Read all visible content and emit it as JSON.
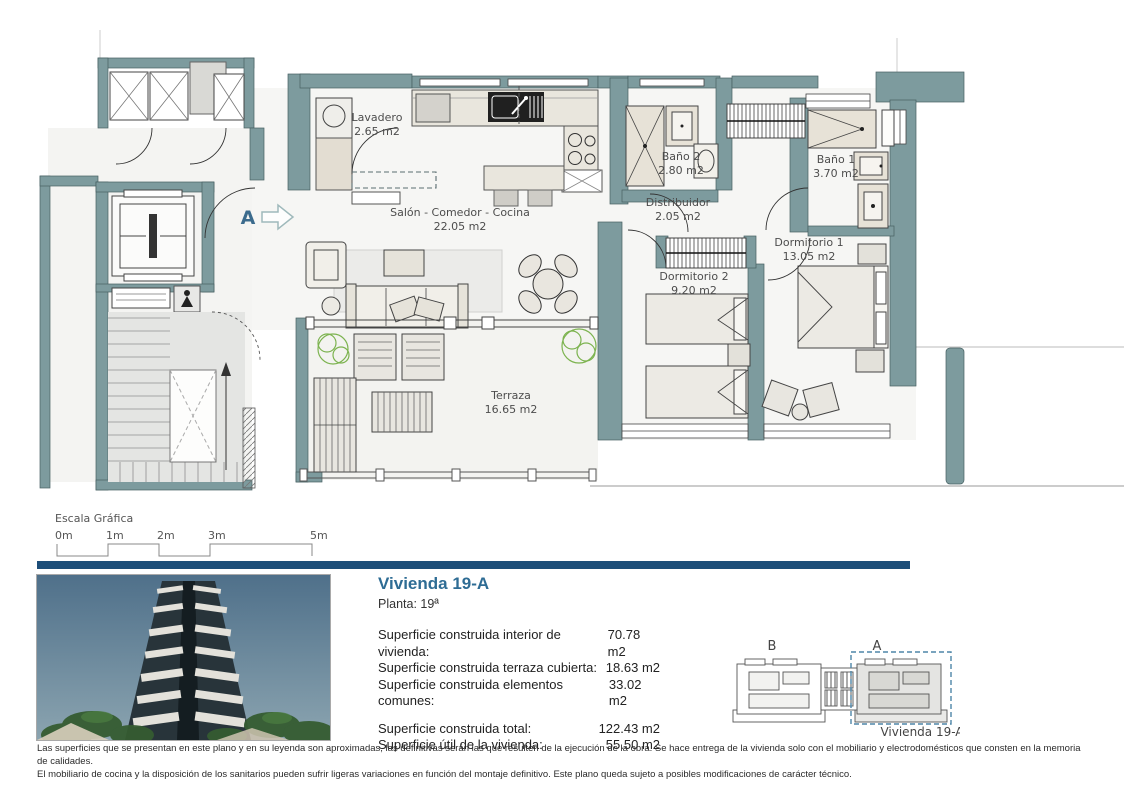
{
  "plan": {
    "entrance_marker": "A",
    "rooms": [
      {
        "name": "Lavadero",
        "area": "2.65 m2"
      },
      {
        "name": "Salón - Comedor - Cocina",
        "area": "22.05 m2"
      },
      {
        "name": "Baño 2",
        "area": "2.80 m2"
      },
      {
        "name": "Distribuidor",
        "area": "2.05 m2"
      },
      {
        "name": "Baño 1",
        "area": "3.70 m2"
      },
      {
        "name": "Dormitorio 1",
        "area": "13.05 m2"
      },
      {
        "name": "Dormitorio 2",
        "area": "9.20 m2"
      },
      {
        "name": "Terraza",
        "area": "16.65 m2"
      }
    ]
  },
  "scale_bar": {
    "title": "Escala Gráfica",
    "ticks": [
      "0m",
      "1m",
      "2m",
      "3m",
      "5m"
    ]
  },
  "info_panel": {
    "title": "Vivienda 19-A",
    "floor": "Planta: 19ª",
    "rows": [
      {
        "label": "Superficie construida interior de vivienda:",
        "value": "70.78 m2"
      },
      {
        "label": "Superficie construida terraza cubierta:",
        "value": "18.63 m2"
      },
      {
        "label": "Superficie construida elementos comunes:",
        "value": "33.02 m2"
      }
    ],
    "totals": [
      {
        "label": "Superficie construida total:",
        "value": "122.43 m2"
      },
      {
        "label": "Superficie útil de la vivienda:",
        "value": "55.50 m2"
      }
    ]
  },
  "key_plan": {
    "unit_b": "B",
    "unit_a": "A",
    "caption": "Vivienda 19-A"
  },
  "footer": {
    "line1": "Las superficies que se presentan en este plano y en su leyenda son aproximadas, las definitivas serán las que resulten de la ejecución de la obra. Se hace entrega de la vivienda solo con el mobiliario y electrodomésticos que consten en la memoria de calidades.",
    "line2": "El mobiliario de cocina y la disposición de los sanitarios pueden sufrir ligeras variaciones en función del montaje definitivo. Este plano queda sujeto a posibles modificaciones de carácter técnico."
  },
  "colors": {
    "wall": "#7d9b9e",
    "accent": "#2e6c94",
    "divider": "#1d4e79",
    "plant": "#7cb34f"
  }
}
